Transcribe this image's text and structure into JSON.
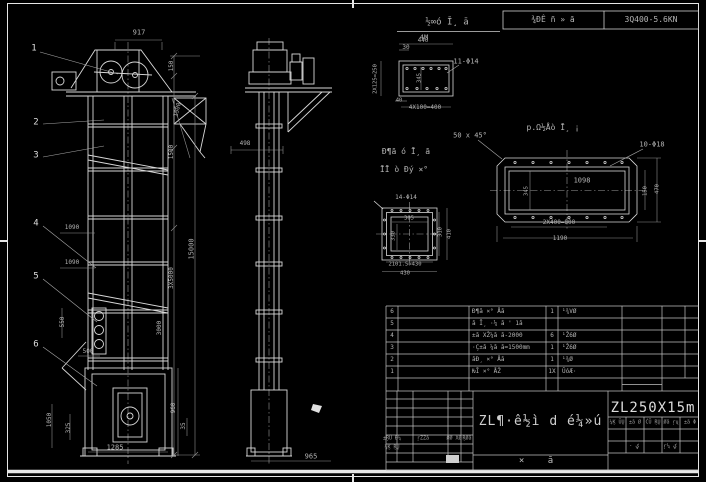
{
  "colors": {
    "background": "#000000",
    "line": "#d8d8d8",
    "dim_line": "#8f8f8f",
    "text": "#b4b4b4",
    "frame": "#e6e6e6",
    "stamp": "#cfcfcf"
  },
  "header": {
    "view_title": "½∞ó Ī¸ ā",
    "view_scale": "4M",
    "field1": "¾ĐÊ ñ » ā",
    "field2": "3Q400-5.6KN"
  },
  "labels": [
    {
      "t": "½∞ó Ī¸ ā",
      "x": 447,
      "y": 23,
      "s": 9,
      "name": "view-title"
    },
    {
      "t": "4M",
      "x": 424,
      "y": 38,
      "s": 7,
      "name": "view-scale"
    },
    {
      "t": "¾ĐÊ ñ » ā",
      "x": 553,
      "y": 20,
      "s": 8,
      "name": "header-field-1"
    },
    {
      "t": "3Q400-5.6KN",
      "x": 651,
      "y": 20,
      "s": 8,
      "name": "header-field-2"
    },
    {
      "t": "1",
      "x": 34,
      "y": 49,
      "s": 9,
      "c": "#dedede",
      "name": "balloon-1"
    },
    {
      "t": "2",
      "x": 36,
      "y": 123,
      "s": 9,
      "c": "#dedede",
      "name": "balloon-2"
    },
    {
      "t": "3",
      "x": 36,
      "y": 156,
      "s": 9,
      "c": "#dedede",
      "name": "balloon-3"
    },
    {
      "t": "4",
      "x": 36,
      "y": 224,
      "s": 9,
      "c": "#dedede",
      "name": "balloon-4"
    },
    {
      "t": "5",
      "x": 36,
      "y": 277,
      "s": 9,
      "c": "#dedede",
      "name": "balloon-5"
    },
    {
      "t": "6",
      "x": 36,
      "y": 345,
      "s": 9,
      "c": "#dedede",
      "name": "balloon-6"
    },
    {
      "t": "917",
      "x": 139,
      "y": 33,
      "s": 7
    },
    {
      "t": "150",
      "x": 172,
      "y": 66,
      "s": 6,
      "r": -90
    },
    {
      "t": "1500",
      "x": 178,
      "y": 110,
      "s": 6,
      "r": -75
    },
    {
      "t": "1500",
      "x": 172,
      "y": 152,
      "s": 6,
      "r": -90
    },
    {
      "t": "15000",
      "x": 192,
      "y": 249,
      "s": 7,
      "r": -90
    },
    {
      "t": "3X5000",
      "x": 172,
      "y": 278,
      "s": 6,
      "r": -90
    },
    {
      "t": "1090",
      "x": 72,
      "y": 228,
      "s": 6
    },
    {
      "t": "1090",
      "x": 72,
      "y": 263,
      "s": 6
    },
    {
      "t": "550",
      "x": 63,
      "y": 322,
      "s": 6,
      "r": -90
    },
    {
      "t": "500",
      "x": 88,
      "y": 352,
      "s": 6
    },
    {
      "t": "3000",
      "x": 160,
      "y": 328,
      "s": 6,
      "r": -90
    },
    {
      "t": "1050",
      "x": 50,
      "y": 420,
      "s": 6,
      "r": -90
    },
    {
      "t": "325",
      "x": 69,
      "y": 428,
      "s": 6,
      "r": -90
    },
    {
      "t": "960",
      "x": 174,
      "y": 408,
      "s": 6,
      "r": -90
    },
    {
      "t": "35",
      "x": 184,
      "y": 426,
      "s": 6,
      "r": -90
    },
    {
      "t": "1285",
      "x": 115,
      "y": 448,
      "s": 7
    },
    {
      "t": "498",
      "x": 245,
      "y": 144,
      "s": 6
    },
    {
      "t": "965",
      "x": 311,
      "y": 457,
      "s": 7
    },
    {
      "t": "440",
      "x": 423,
      "y": 41,
      "s": 6
    },
    {
      "t": "30",
      "x": 406,
      "y": 48,
      "s": 6
    },
    {
      "t": "11-Φ14",
      "x": 466,
      "y": 62,
      "s": 7
    },
    {
      "t": "2X125=250",
      "x": 376,
      "y": 79,
      "s": 5.5,
      "r": -90
    },
    {
      "t": "345",
      "x": 420,
      "y": 78,
      "s": 5.5,
      "r": -90
    },
    {
      "t": "40",
      "x": 399,
      "y": 101,
      "s": 5.5
    },
    {
      "t": "4X100=400",
      "x": 425,
      "y": 108,
      "s": 6
    },
    {
      "t": "50 x 45°",
      "x": 470,
      "y": 136,
      "s": 7
    },
    {
      "t": "p.Ω½Åò Ī¸ ¡",
      "x": 553,
      "y": 128,
      "s": 8,
      "name": "detail-b-title"
    },
    {
      "t": "10-Φ18",
      "x": 652,
      "y": 145,
      "s": 7
    },
    {
      "t": "1098",
      "x": 582,
      "y": 181,
      "s": 7
    },
    {
      "t": "345",
      "x": 527,
      "y": 191,
      "s": 5.5,
      "r": -90
    },
    {
      "t": "150",
      "x": 646,
      "y": 191,
      "s": 5.5,
      "r": -90
    },
    {
      "t": "470",
      "x": 658,
      "y": 189,
      "s": 5.5,
      "r": -90
    },
    {
      "t": "2X400=800",
      "x": 559,
      "y": 223,
      "s": 6
    },
    {
      "t": "1190",
      "x": 560,
      "y": 239,
      "s": 6
    },
    {
      "t": "Đ¶ā ó Ī¸ ā",
      "x": 406,
      "y": 152,
      "s": 8,
      "name": "detail-c-title-1"
    },
    {
      "t": "ĪĪ ò Đý ×°",
      "x": 404,
      "y": 170,
      "s": 8,
      "name": "detail-c-title-2"
    },
    {
      "t": "14-Φ14",
      "x": 406,
      "y": 198,
      "s": 6
    },
    {
      "t": "305",
      "x": 409,
      "y": 219,
      "s": 5.5
    },
    {
      "t": "330",
      "x": 394,
      "y": 236,
      "s": 5.5,
      "r": -90
    },
    {
      "t": "310",
      "x": 441,
      "y": 232,
      "s": 5.5,
      "r": -90
    },
    {
      "t": "410",
      "x": 450,
      "y": 234,
      "s": 5.5,
      "r": -90
    },
    {
      "t": "2101.5=430",
      "x": 405,
      "y": 265,
      "s": 5.5
    },
    {
      "t": "430",
      "x": 405,
      "y": 274,
      "s": 5.5
    }
  ],
  "bom": {
    "header": {
      "no": "Øā¼",
      "code": "' ā¼Ž",
      "name": "ŽĐºÆ",
      "qty": "Øāl",
      "material": "ŗŽ āT",
      "weight_top": "«Ž¼X¼ØŽ",
      "weight_bottom": "ØŽ ā¸",
      "note": "±,XØ"
    },
    "rows": [
      {
        "no": "6",
        "code": "",
        "name": "Đ¶ā ×° Åā",
        "qty": "1",
        "mat": "¹¾VØ"
      },
      {
        "no": "5",
        "code": "",
        "name": "ā Ī¸ ·¼ ā ' 1ā",
        "qty": "",
        "mat": ""
      },
      {
        "no": "4",
        "code": "",
        "name": "±ā XŽ¼ā ā-2000",
        "qty": "6",
        "mat": "¹Ž6Ø"
      },
      {
        "no": "3",
        "code": "",
        "name": "·Ç±ā ¼ā ā=1500mm",
        "qty": "1",
        "mat": "¹Ž6Ø"
      },
      {
        "no": "2",
        "code": "",
        "name": "āĐ¸ ×° Åā",
        "qty": "1",
        "mat": "¹¾Ø"
      },
      {
        "no": "1",
        "code": "",
        "name": "ǶĪ ×° ÅŽ",
        "qty": "1X",
        "mat": "ŪóÆ·"
      }
    ]
  },
  "title_block": {
    "model": "ZL250X15m",
    "title": "ZL¶·ê½ì d é¼»ú",
    "doc_type": "× ā",
    "sig": [
      "±ŖŪ Đ¼",
      "ŗŽŽā",
      "ØØ XØ",
      "ŖØā"
    ],
    "sig_row2": "¼Ķ ŖŲ",
    "mini": [
      "¼Ķ ŪŲ",
      "±ā Ø",
      "ĆŪ ŖŲ",
      "Øā ŗų",
      "±ā Φ"
    ],
    "sheet_total": "· ؼ",
    "sheet_no": "ŗ¼ ؼ"
  }
}
